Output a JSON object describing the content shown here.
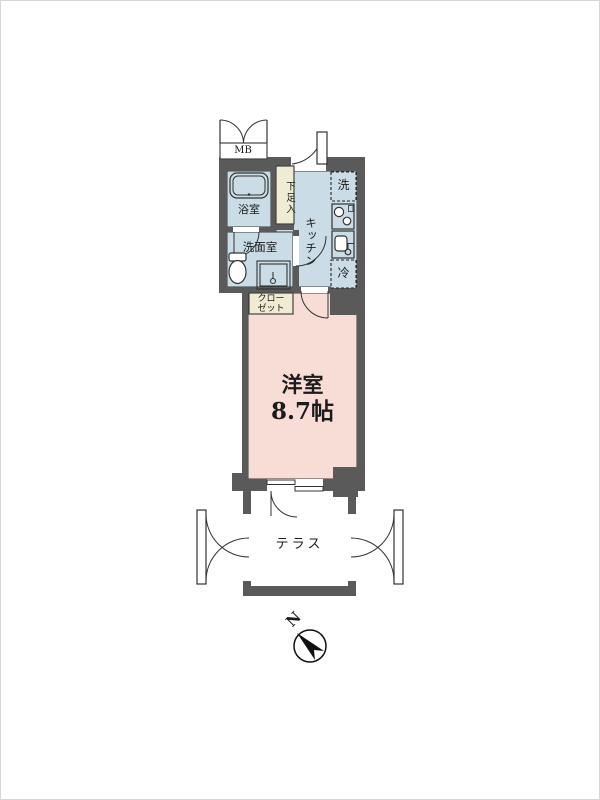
{
  "floorplan": {
    "labels": {
      "meter_box": "MB",
      "bathroom": "浴室",
      "shoe_cabinet": "下足入",
      "kitchen": "キッチン",
      "washer": "洗",
      "fridge": "冷",
      "washroom": "洗面室",
      "closet_line1": "クロー",
      "closet_line2": "ゼット",
      "main_room_name": "洋室",
      "main_room_size": "8.7帖",
      "terrace": "テラス",
      "compass_north": "N"
    },
    "colors": {
      "wall": "#5a5a5a",
      "wet_area_floor": "#cadde6",
      "main_room_floor": "#f8dcd6",
      "storage_fill": "#f0ebd3",
      "outline": "#333333"
    }
  }
}
